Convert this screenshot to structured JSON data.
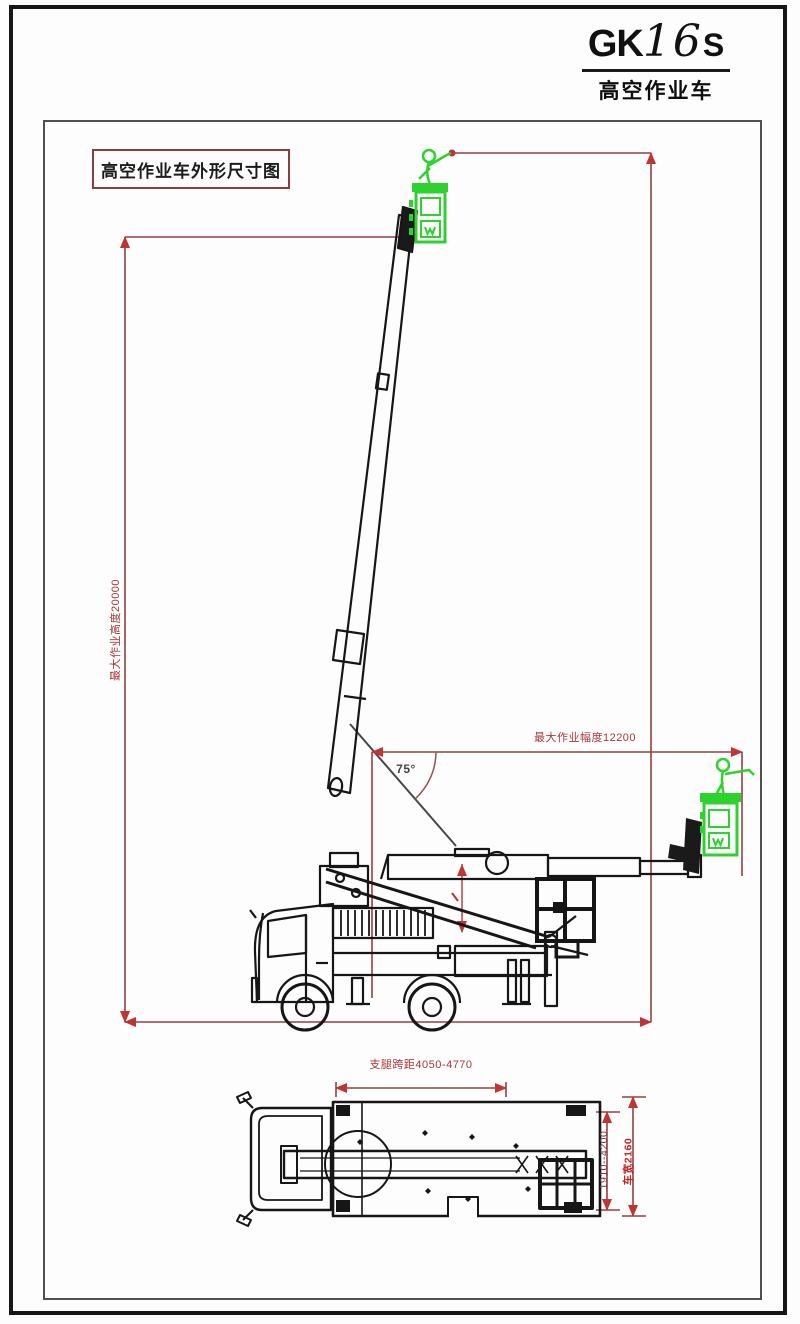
{
  "logo": {
    "brand": "GK",
    "model": "16",
    "suffix": "S",
    "subtitle": "高空作业车"
  },
  "title_box": {
    "label": "高空作业车外形尺寸图"
  },
  "side_view": {
    "max_height_label": "最大作业高度20000",
    "max_radius_label": "最大作业幅度12200",
    "boom_angle_label": "75°"
  },
  "plan_view": {
    "outrigger_span_label": "支腿跨距4050-4770",
    "outrigger_extend_label": "1910--4200",
    "vehicle_width_label": "车宽2160"
  },
  "colors": {
    "dimension_line": "#95403f",
    "dimension_arrow": "#c03434",
    "dimension_text": "#a83636",
    "drawing_line": "#161616",
    "basket_green": "#2ed12e",
    "frame_border": "#4f4f4f",
    "title_border": "#8d3b3b"
  }
}
